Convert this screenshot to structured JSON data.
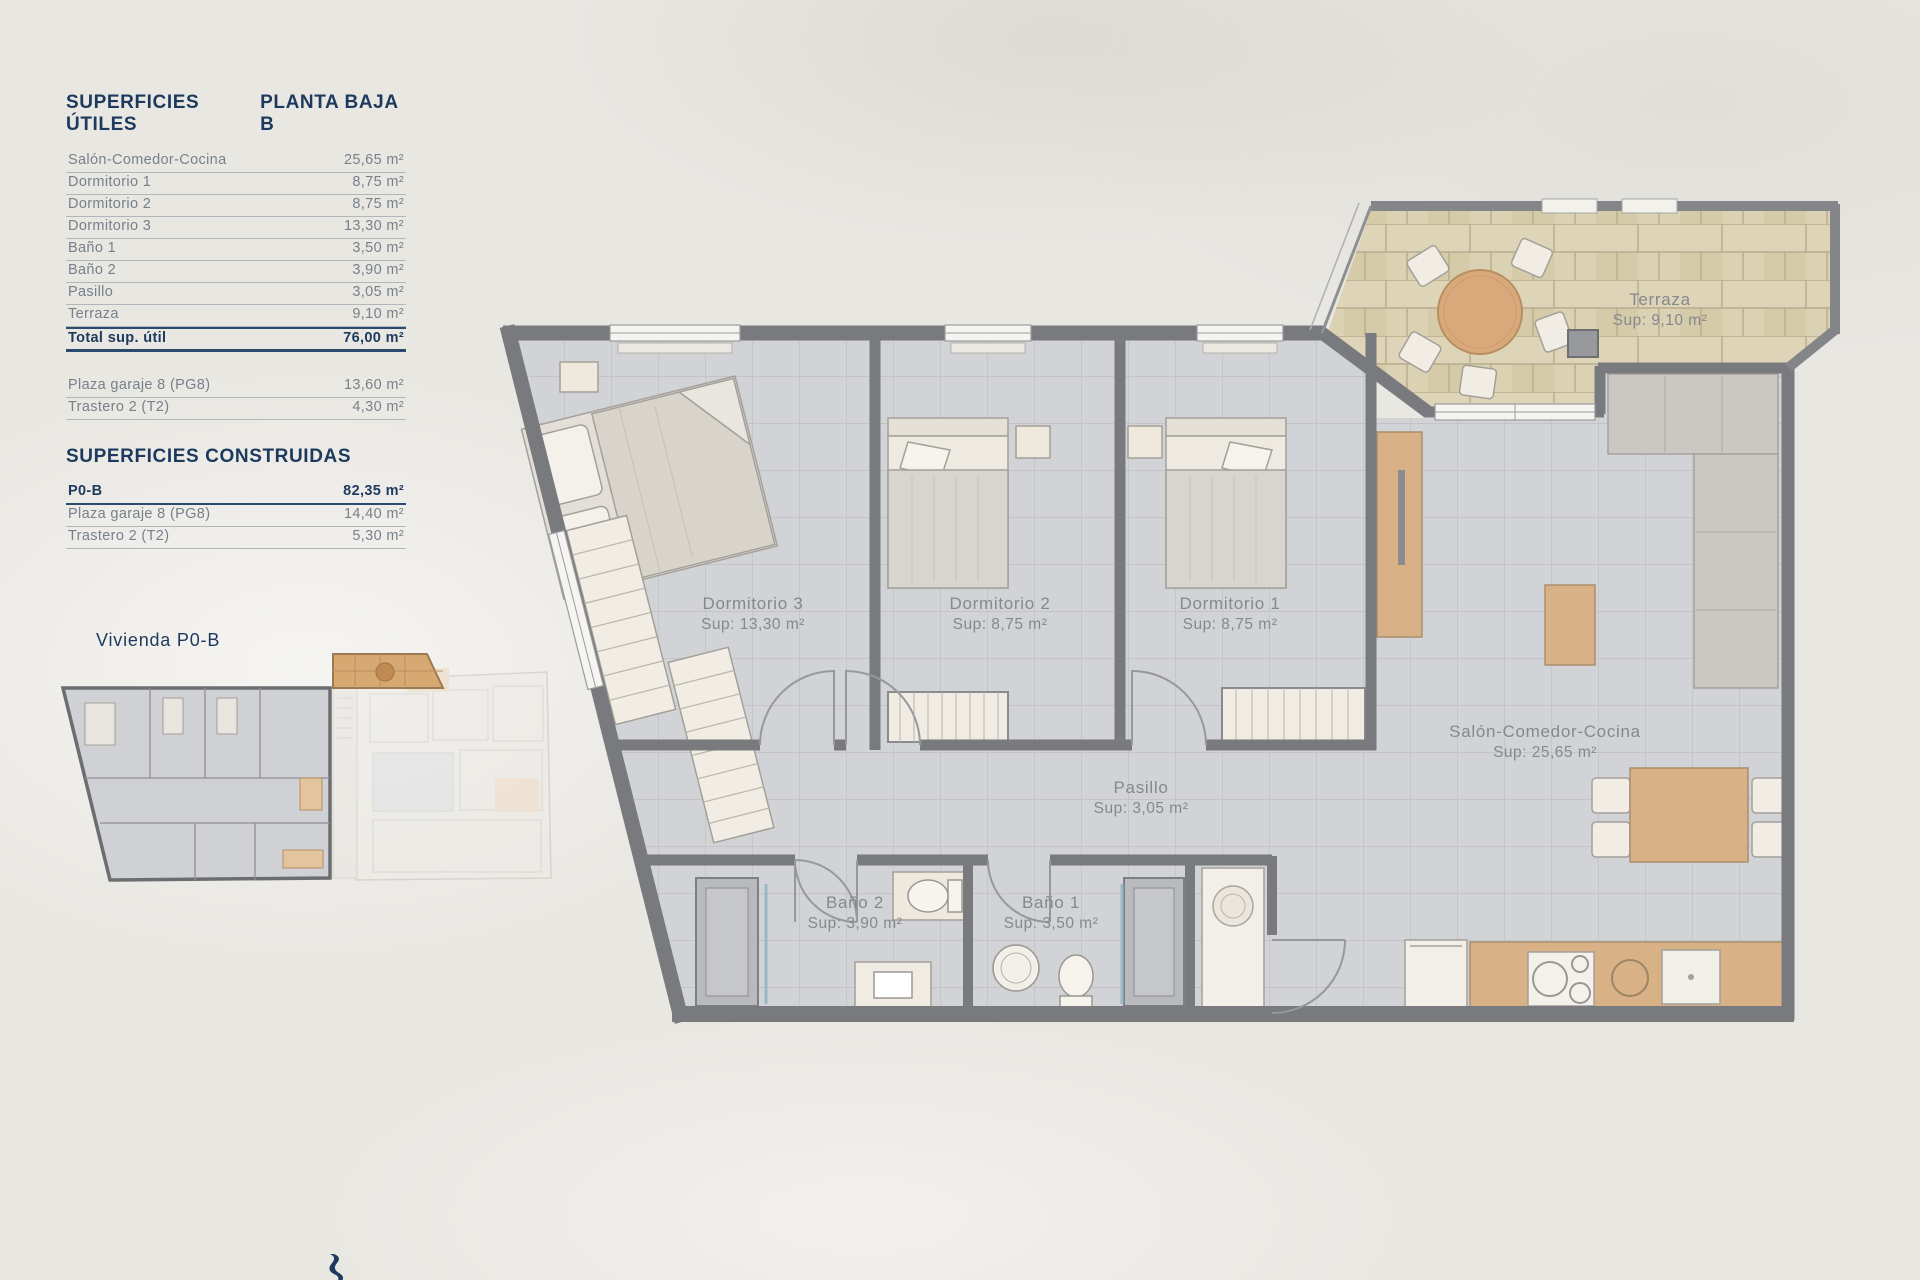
{
  "colors": {
    "accent_navy": "#1d3a5e",
    "table_text": "#76818b",
    "rule_gray": "#b2b6ba",
    "wall_gray": "#797a7d",
    "floor_tile": "#d2d3d6",
    "tile_line": "#bfc0c3",
    "terrace_stone": "#dbd1b3",
    "terrace_line": "#b7ac8c",
    "wood": "#d8b286",
    "furniture_cream": "#f1ede4",
    "sofa_gray": "#cbc8c3",
    "plan_label_gray": "#85888c"
  },
  "tables": {
    "utiles": {
      "title": "SUPERFICIES ÚTILES",
      "floor": "PLANTA BAJA B",
      "rows": [
        {
          "label": "Salón-Comedor-Cocina",
          "value": "25,65 m²"
        },
        {
          "label": "Dormitorio 1",
          "value": "8,75 m²"
        },
        {
          "label": "Dormitorio 2",
          "value": "8,75 m²"
        },
        {
          "label": "Dormitorio 3",
          "value": "13,30 m²"
        },
        {
          "label": "Baño 1",
          "value": "3,50 m²"
        },
        {
          "label": "Baño 2",
          "value": "3,90 m²"
        },
        {
          "label": "Pasillo",
          "value": "3,05 m²"
        },
        {
          "label": "Terraza",
          "value": "9,10 m²"
        }
      ],
      "total": {
        "label": "Total sup. útil",
        "value": "76,00 m²"
      },
      "extras": [
        {
          "label": "Plaza garaje 8 (PG8)",
          "value": "13,60 m²"
        },
        {
          "label": "Trastero 2 (T2)",
          "value": "4,30 m²"
        }
      ]
    },
    "construidas": {
      "title": "SUPERFICIES CONSTRUIDAS",
      "rows": [
        {
          "label": "P0-B",
          "value": "82,35 m²"
        },
        {
          "label": "Plaza garaje 8 (PG8)",
          "value": "14,40 m²"
        },
        {
          "label": "Trastero 2 (T2)",
          "value": "5,30 m²"
        }
      ]
    }
  },
  "key_plan": {
    "caption": "Vivienda P0-B"
  },
  "plan": {
    "rooms": [
      {
        "name": "Dormitorio 3",
        "sup": "Sup: 13,30 m²"
      },
      {
        "name": "Dormitorio 2",
        "sup": "Sup: 8,75 m²"
      },
      {
        "name": "Dormitorio 1",
        "sup": "Sup: 8,75 m²"
      },
      {
        "name": "Salón-Comedor-Cocina",
        "sup": "Sup: 25,65 m²"
      },
      {
        "name": "Pasillo",
        "sup": "Sup: 3,05 m²"
      },
      {
        "name": "Baño 2",
        "sup": "Sup: 3,90 m²"
      },
      {
        "name": "Baño 1",
        "sup": "Sup: 3,50 m²"
      },
      {
        "name": "Terraza",
        "sup": "Sup: 9,10 m²"
      }
    ]
  }
}
